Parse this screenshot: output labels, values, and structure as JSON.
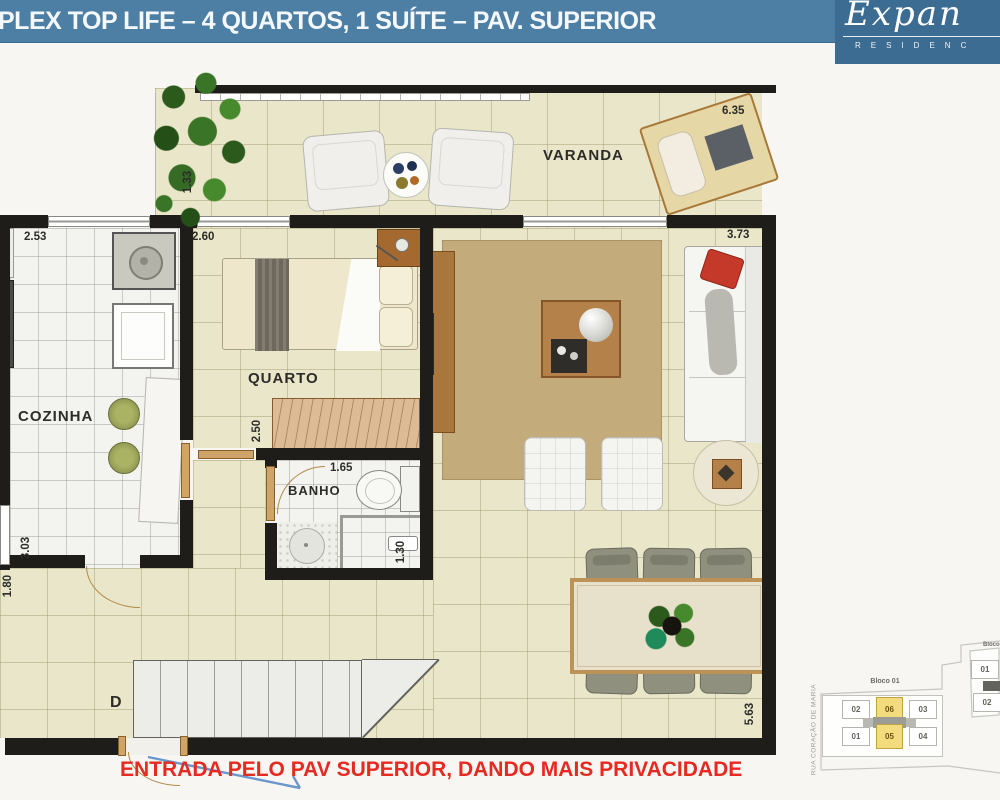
{
  "header": {
    "title": "PLEX TOP LIFE – 4 QUARTOS, 1 SUÍTE – PAV. SUPERIOR"
  },
  "logo": {
    "name": "Expan",
    "subtitle": "RESIDENC"
  },
  "plan": {
    "rooms": {
      "varanda": "VARANDA",
      "cozinha": "COZINHA",
      "quarto": "QUARTO",
      "banho": "BANHO"
    },
    "stairs_label": "D",
    "measurements": {
      "varanda_width": "6.35",
      "varanda_depth": "1.33",
      "cozinha_width": "2.53",
      "quarto_width": "2.60",
      "quarto_closet_width": "2.50",
      "sala_width": "3.73",
      "banho_width": "1.65",
      "banho_depth": "1.30",
      "cozinha_depth": "3.03",
      "sala_depth": "5.63",
      "entry_width": "1.80"
    }
  },
  "annotation": {
    "entry_note": "ENTRADA PELO PAV SUPERIOR, DANDO MAIS PRIVACIDADE"
  },
  "keyplan": {
    "street": "RUA CORAÇÃO DE MARIA",
    "bloco1": {
      "label": "Bloco 01",
      "units_top": [
        "02",
        "06",
        "03"
      ],
      "units_bottom": [
        "01",
        "05",
        "04"
      ],
      "highlighted_units": [
        "06",
        "05"
      ]
    },
    "bloco2": {
      "label": "Bloco",
      "units": [
        "01",
        "02"
      ]
    }
  },
  "colors": {
    "header_blue": "#4d7fa4",
    "logo_blue": "#3c6c92",
    "annotation_red": "#e62a21",
    "arrow_blue": "#6b97cc",
    "highlight_yellow": "#f3dc7e"
  }
}
